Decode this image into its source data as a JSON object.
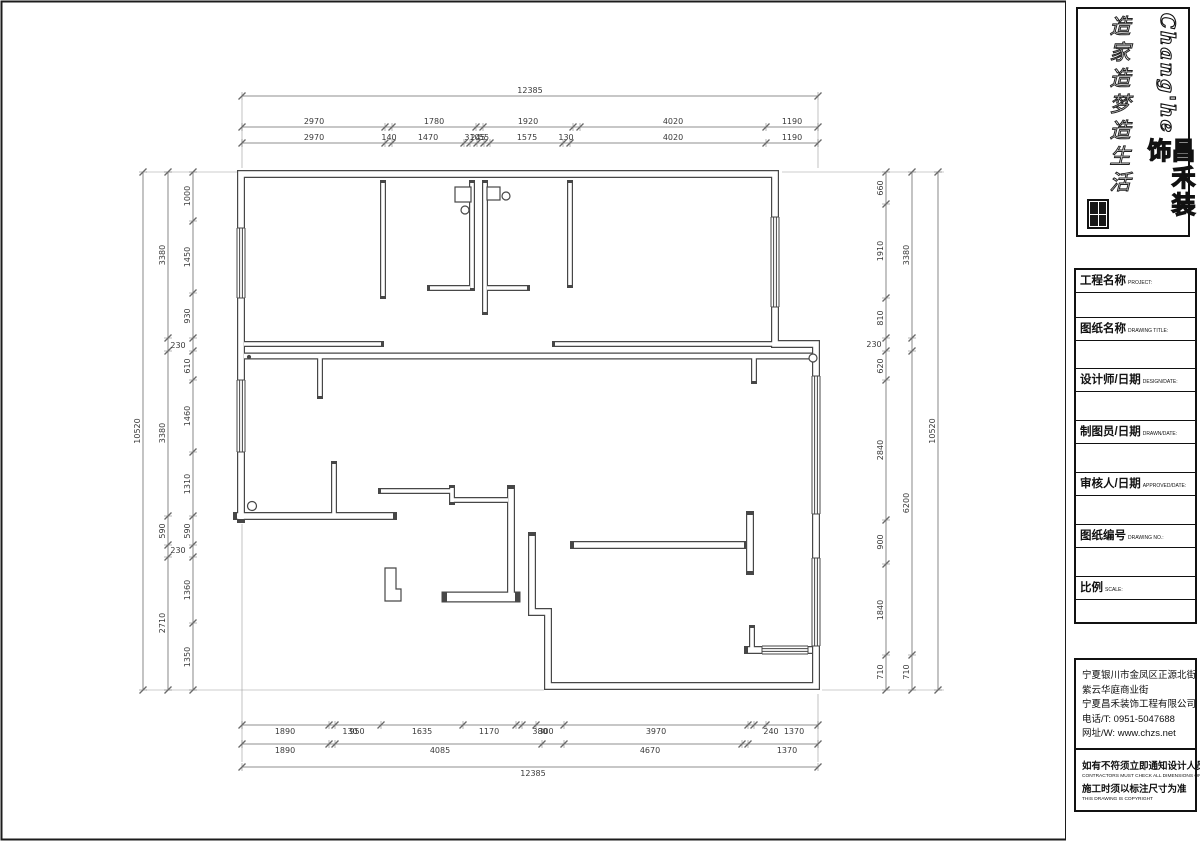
{
  "colors": {
    "wall": "#474747",
    "dim": "#6a6a6a",
    "text": "#3a3a3a",
    "frame": "#1c1c1c"
  },
  "brand": {
    "en": "Chang'he",
    "cn": "昌禾装饰",
    "slogan": "造家造梦造生活"
  },
  "titleblock": {
    "rows": [
      {
        "label": "工程名称",
        "sub": "PROJECT:"
      },
      {
        "label": "图纸名称",
        "sub": "DRAWING TITLE:"
      },
      {
        "label": "设计师/日期",
        "sub": "DESIGN/DATE:"
      },
      {
        "label": "制图员/日期",
        "sub": "DRAWN/DATE:"
      },
      {
        "label": "审核人/日期",
        "sub": "APPROVED/DATE:"
      },
      {
        "label": "图纸编号",
        "sub": "DRAWING NO.:"
      },
      {
        "label": "比例",
        "sub": "SCALE:"
      }
    ]
  },
  "address": {
    "lines": [
      "宁夏银川市金凤区正源北街",
      "紫云华庭商业街",
      "宁夏昌禾装饰工程有限公司",
      "电话/T: 0951-5047688",
      "网址/W: www.chzs.net"
    ]
  },
  "notes": [
    {
      "cn": "如有不符须立即通知设计人员",
      "en": "CONTRACTORS MUST CHECK ALL DIMENSIONS ON SITE"
    },
    {
      "cn": "施工时须以标注尺寸为准",
      "en": "THIS DRAWING IS COPYRIGHT"
    }
  ],
  "dimensions": {
    "top": [
      {
        "y": 96,
        "side": -1,
        "ticks": [
          242,
          818
        ],
        "labels": [
          {
            "t": "12385",
            "x": 530
          }
        ]
      },
      {
        "y": 127,
        "side": -1,
        "ticks": [
          242,
          385,
          392,
          476,
          483,
          573,
          580,
          766,
          818
        ],
        "labels": [
          {
            "t": "2970",
            "x": 314
          },
          {
            "t": "1780",
            "x": 434
          },
          {
            "t": "1920",
            "x": 528
          },
          {
            "t": "4020",
            "x": 673
          },
          {
            "t": "1190",
            "x": 792
          }
        ]
      },
      {
        "y": 143,
        "side": -1,
        "ticks": [
          242,
          385,
          392,
          464,
          470,
          477,
          484,
          490,
          563,
          570,
          766,
          818
        ],
        "labels": [
          {
            "t": "2970",
            "x": 314
          },
          {
            "t": "140",
            "x": 389
          },
          {
            "t": "1470",
            "x": 428
          },
          {
            "t": "310",
            "x": 472
          },
          {
            "t": "245",
            "x": 478
          },
          {
            "t": "55",
            "x": 484
          },
          {
            "t": "1575",
            "x": 527
          },
          {
            "t": "130",
            "x": 566
          },
          {
            "t": "4020",
            "x": 673
          },
          {
            "t": "1190",
            "x": 792
          }
        ]
      }
    ],
    "bottom": [
      {
        "y": 725,
        "side": 1,
        "ticks": [
          242,
          329,
          335,
          381,
          463,
          516,
          522,
          536,
          564,
          748,
          754,
          766,
          818
        ],
        "labels": [
          {
            "t": "1890",
            "x": 285
          },
          {
            "t": "130",
            "x": 350
          },
          {
            "t": "950",
            "x": 357
          },
          {
            "t": "1635",
            "x": 422
          },
          {
            "t": "1170",
            "x": 489
          },
          {
            "t": "380",
            "x": 540
          },
          {
            "t": "300",
            "x": 546
          },
          {
            "t": "3970",
            "x": 656
          },
          {
            "t": "240",
            "x": 771
          },
          {
            "t": "1370",
            "x": 794
          }
        ]
      },
      {
        "y": 744,
        "side": 1,
        "ticks": [
          242,
          329,
          335,
          542,
          564,
          742,
          748,
          818
        ],
        "labels": [
          {
            "t": "1890",
            "x": 285
          },
          {
            "t": "4085",
            "x": 440
          },
          {
            "t": "4670",
            "x": 650
          },
          {
            "t": "1370",
            "x": 787
          }
        ]
      },
      {
        "y": 767,
        "side": 1,
        "ticks": [
          242,
          818
        ],
        "labels": [
          {
            "t": "12385",
            "x": 533
          }
        ]
      }
    ],
    "left": [
      {
        "x": 143,
        "ticks": [
          172,
          690
        ],
        "labels": [
          {
            "t": "10520",
            "y": 431
          }
        ]
      },
      {
        "x": 168,
        "ticks": [
          172,
          338,
          351,
          516,
          545,
          557,
          690
        ],
        "labels": [
          {
            "t": "3380",
            "y": 255
          },
          {
            "t": "3380",
            "y": 433
          },
          {
            "t": "590",
            "y": 531
          },
          {
            "t": "2710",
            "y": 623
          }
        ]
      },
      {
        "x": 193,
        "ticks": [
          172,
          221,
          293,
          338,
          351,
          380,
          452,
          516,
          545,
          557,
          623,
          690
        ],
        "labels": [
          {
            "t": "1000",
            "y": 196
          },
          {
            "t": "1450",
            "y": 257
          },
          {
            "t": "930",
            "y": 316
          },
          {
            "t": "610",
            "y": 366
          },
          {
            "t": "1460",
            "y": 416
          },
          {
            "t": "1310",
            "y": 484
          },
          {
            "t": "590",
            "y": 531
          },
          {
            "t": "1360",
            "y": 590
          },
          {
            "t": "1350",
            "y": 657
          }
        ]
      }
    ],
    "right": [
      {
        "x": 886,
        "ticks": [
          172,
          204,
          298,
          338,
          351,
          380,
          520,
          564,
          655,
          690
        ],
        "labels": [
          {
            "t": "660",
            "y": 188
          },
          {
            "t": "1910",
            "y": 251
          },
          {
            "t": "810",
            "y": 318
          },
          {
            "t": "620",
            "y": 366
          },
          {
            "t": "2840",
            "y": 450
          },
          {
            "t": "900",
            "y": 542
          },
          {
            "t": "1840",
            "y": 610
          },
          {
            "t": "710",
            "y": 672
          }
        ]
      },
      {
        "x": 912,
        "ticks": [
          172,
          338,
          351,
          655,
          690
        ],
        "labels": [
          {
            "t": "3380",
            "y": 255
          },
          {
            "t": "6200",
            "y": 503
          },
          {
            "t": "710",
            "y": 672
          }
        ]
      },
      {
        "x": 938,
        "ticks": [
          172,
          690
        ],
        "labels": [
          {
            "t": "10520",
            "y": 431
          }
        ]
      }
    ],
    "floating": [
      {
        "t": "230",
        "x": 178,
        "y": 348
      },
      {
        "t": "230",
        "x": 178,
        "y": 553
      },
      {
        "t": "230",
        "x": 874,
        "y": 347
      }
    ]
  },
  "floorplan": {
    "walls": [
      {
        "d": "M241,519 L241,174 L775,174 L775,344 L816,344 L816,686 L548,686 L548,612 L532,612 L532,536",
        "w": 8
      },
      {
        "d": "M237,516 H393",
        "w": 8
      },
      {
        "d": "M511,489 V593",
        "w": 8
      },
      {
        "d": "M447,597 H515",
        "w": 11
      },
      {
        "d": "M381,491 H452",
        "w": 6
      },
      {
        "d": "M452,488 V502",
        "w": 6
      },
      {
        "d": "M452,500 H508",
        "w": 6
      },
      {
        "d": "M244,356 H814",
        "w": 7
      },
      {
        "d": "M244,344 H381",
        "w": 6
      },
      {
        "d": "M555,344 H775",
        "w": 6
      },
      {
        "d": "M320,356 V396",
        "w": 6
      },
      {
        "d": "M754,356 V381",
        "w": 6
      },
      {
        "d": "M383,183 V296",
        "w": 6
      },
      {
        "d": "M472,183 V288",
        "w": 6
      },
      {
        "d": "M485,183 V312",
        "w": 6
      },
      {
        "d": "M570,183 V285",
        "w": 6
      },
      {
        "d": "M430,288 H470",
        "w": 6
      },
      {
        "d": "M487,288 H527",
        "w": 6
      },
      {
        "d": "M334,464 V516",
        "w": 6
      },
      {
        "d": "M574,545 H744",
        "w": 8
      },
      {
        "d": "M750,515 V571",
        "w": 8
      },
      {
        "d": "M748,650 H812",
        "w": 8
      },
      {
        "d": "M752,628 V650",
        "w": 6
      }
    ],
    "windows": [
      {
        "o": "v",
        "c": 241,
        "a": 228,
        "b": 298
      },
      {
        "o": "v",
        "c": 241,
        "a": 380,
        "b": 452
      },
      {
        "o": "v",
        "c": 775,
        "a": 217,
        "b": 307
      },
      {
        "o": "v",
        "c": 816,
        "a": 376,
        "b": 514
      },
      {
        "o": "v",
        "c": 816,
        "a": 558,
        "b": 646
      },
      {
        "o": "h",
        "c": 650,
        "a": 762,
        "b": 808
      }
    ],
    "boxes": [
      {
        "x": 455,
        "y": 187,
        "w": 16,
        "h": 15
      },
      {
        "x": 487,
        "y": 187,
        "w": 13,
        "h": 13
      }
    ],
    "polys": [
      "M385,568 h11 v21 h5 v12 h-16 Z"
    ],
    "circles": [
      {
        "x": 465,
        "y": 210,
        "r": 4
      },
      {
        "x": 506,
        "y": 196,
        "r": 4
      },
      {
        "x": 813,
        "y": 358,
        "r": 4
      },
      {
        "x": 252,
        "y": 506,
        "r": 4.5
      },
      {
        "x": 249,
        "y": 357,
        "r": 1.5,
        "f": 1
      }
    ],
    "ext": [
      [
        242,
        100,
        242,
        168
      ],
      [
        818,
        100,
        818,
        168
      ],
      [
        146,
        172,
        237,
        172
      ],
      [
        146,
        690,
        544,
        690
      ],
      [
        944,
        172,
        782,
        172
      ],
      [
        944,
        690,
        822,
        690
      ],
      [
        242,
        524,
        242,
        762
      ],
      [
        818,
        694,
        818,
        762
      ]
    ]
  }
}
